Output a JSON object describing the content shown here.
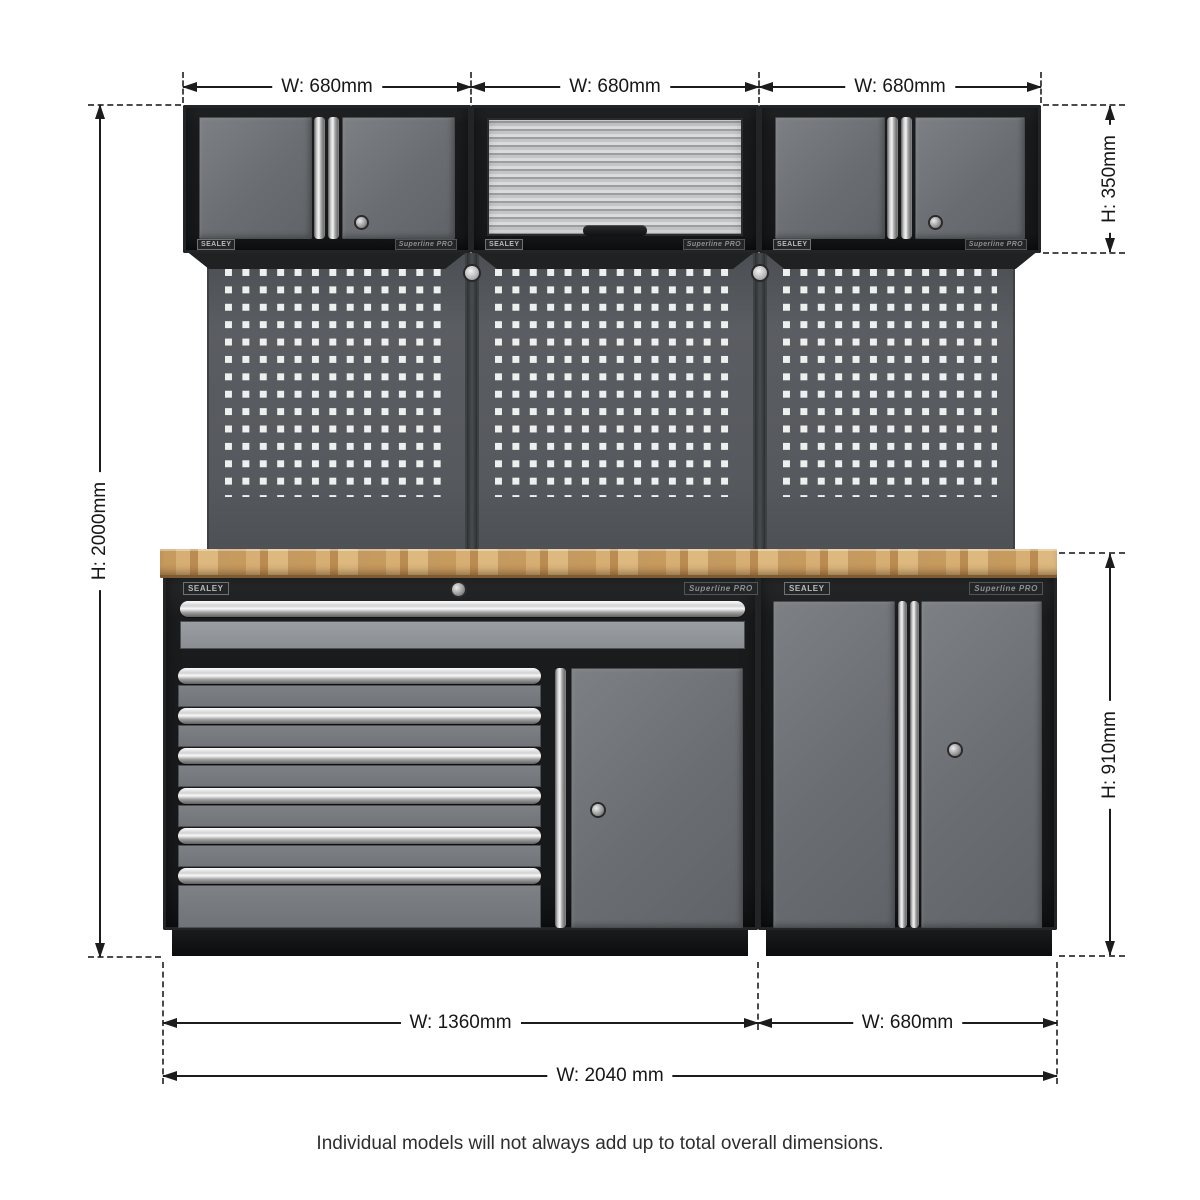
{
  "product": {
    "brand_badge": "SEALEY",
    "series_badge": "Superline PRO"
  },
  "annotations": {
    "top_widths": [
      "W: 680mm",
      "W: 680mm",
      "W: 680mm"
    ],
    "overall_height": "H: 2000mm",
    "wall_unit_height": "H: 350mm",
    "base_unit_height": "H: 910mm",
    "base_widths": [
      "W: 1360mm",
      "W: 680mm"
    ],
    "overall_width": "W: 2040 mm",
    "footnote": "Individual models will not always add up to total overall dimensions."
  },
  "colors": {
    "frame_black": "#1a1c1e",
    "door_grey": "#6d7074",
    "pegboard_grey": "#55585c",
    "worktop_wood": "#c99b61",
    "chrome": "#d9d9d9",
    "dimension_line": "#1c1c1c",
    "background": "#ffffff"
  }
}
